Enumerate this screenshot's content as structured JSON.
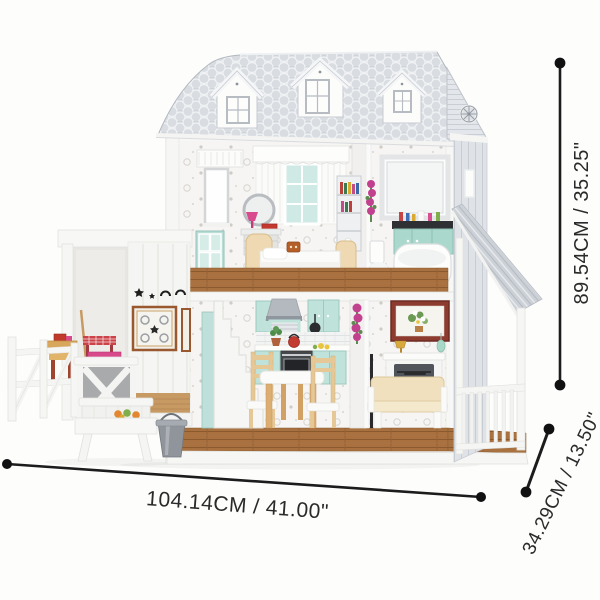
{
  "figure": {
    "subject": "white farmhouse dollhouse with furniture, barn extension, paddock fence and porch"
  },
  "annotations": {
    "width": {
      "label": "104.14CM / 41.00\""
    },
    "height": {
      "label": "89.54CM / 35.25\""
    },
    "depth": {
      "label": "34.29CM / 13.50\""
    }
  },
  "palette": {
    "background": "#fdfdfc",
    "roof_shingle_gray": "#cfd4da",
    "siding_gray": "#dfe3e7",
    "wall_white": "#f5f5f3",
    "wallpaper_base": "#f6f5f3",
    "mint_teal": "#bfe3da",
    "wood_floor_brown": "#a8713f",
    "barn_floor_tan": "#c89a63",
    "furniture_cream": "#f0e0bd",
    "furniture_wood_tan": "#e6c897",
    "accent_red": "#c4372e",
    "accent_magenta": "#c2418f",
    "bucket_gray": "#8f959b",
    "dimension_line_black": "#1c1c1c"
  }
}
